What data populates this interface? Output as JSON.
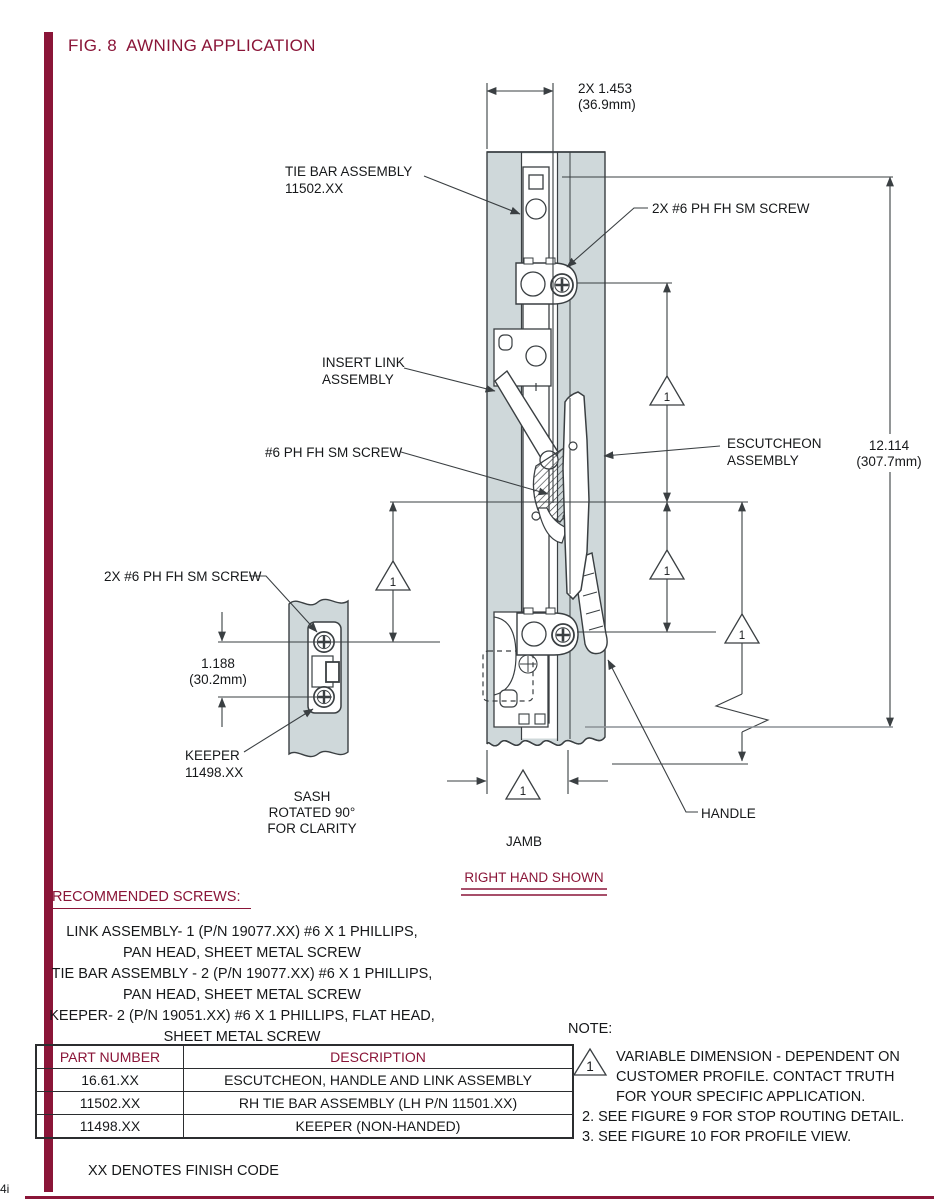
{
  "page": {
    "title": "FIG. 8  AWNING APPLICATION",
    "footer_note": "XX DENOTES FINISH CODE",
    "page_mark": "4i"
  },
  "colors": {
    "maroon": "#8a1538",
    "jamb_fill": "#cfd8da",
    "line": "#3a3f42"
  },
  "diagram": {
    "labels": {
      "tie_bar_1": "TIE BAR ASSEMBLY",
      "tie_bar_2": "11502.XX",
      "screw_top": "2X #6 PH FH SM SCREW",
      "insert_link_1": "INSERT LINK",
      "insert_link_2": "ASSEMBLY",
      "screw_mid": "#6 PH FH SM SCREW",
      "escutcheon_1": "ESCUTCHEON",
      "escutcheon_2": "ASSEMBLY",
      "screw_keeper": "2X #6 PH FH SM SCREW",
      "keeper_1": "KEEPER",
      "keeper_2": "11498.XX",
      "sash_1": "SASH",
      "sash_2": "ROTATED 90°",
      "sash_3": "FOR CLARITY",
      "jamb": "JAMB",
      "handle": "HANDLE"
    },
    "dims": {
      "width_in": "2X 1.453",
      "width_mm": "(36.9mm)",
      "height_in": "12.114",
      "height_mm": "(307.7mm)",
      "keeper_in": "1.188",
      "keeper_mm": "(30.2mm)"
    },
    "flag": "1",
    "right_hand": "RIGHT HAND SHOWN"
  },
  "screws": {
    "heading": "RECOMMENDED SCREWS:",
    "items": [
      {
        "l1": "LINK ASSEMBLY- 1 (P/N 19077.XX) #6 X 1 PHILLIPS,",
        "l2": "PAN HEAD, SHEET METAL SCREW"
      },
      {
        "l1": "TIE BAR ASSEMBLY - 2 (P/N 19077.XX) #6 X 1 PHILLIPS,",
        "l2": "PAN HEAD, SHEET METAL SCREW"
      },
      {
        "l1": "KEEPER- 2 (P/N 19051.XX) #6 X 1 PHILLIPS, FLAT HEAD,",
        "l2": "SHEET METAL SCREW"
      }
    ]
  },
  "table": {
    "headers": [
      "PART NUMBER",
      "DESCRIPTION"
    ],
    "rows": [
      [
        "16.61.XX",
        "ESCUTCHEON, HANDLE AND LINK ASSEMBLY"
      ],
      [
        "11502.XX",
        "RH TIE BAR ASSEMBLY (LH P/N 11501.XX)"
      ],
      [
        "11498.XX",
        "KEEPER (NON-HANDED)"
      ]
    ]
  },
  "note": {
    "heading": "NOTE:",
    "flag": "1",
    "item1_l1": "VARIABLE DIMENSION - DEPENDENT ON",
    "item1_l2": "CUSTOMER PROFILE. CONTACT TRUTH",
    "item1_l3": "FOR YOUR SPECIFIC APPLICATION.",
    "item2": "2. SEE FIGURE 9 FOR STOP ROUTING DETAIL.",
    "item3": "3. SEE FIGURE 10 FOR PROFILE VIEW."
  }
}
